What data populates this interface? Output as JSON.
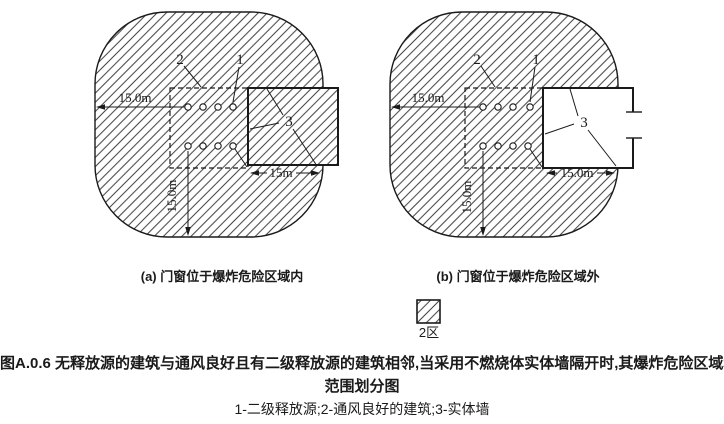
{
  "figure": {
    "id_title_line1": "图A.0.6 无释放源的建筑与通风良好且有二级释放源的建筑相邻,当采用不燃烧体实体墙隔开时,其爆炸危险区域和",
    "id_title_line2": "范围划分图",
    "key_line": "1-二级释放源;2-通风良好的建筑;3-实体墙",
    "legend": {
      "zone_label": "2区"
    },
    "colors": {
      "line": "#1a1a1a",
      "background": "#ffffff"
    },
    "diagram_a": {
      "caption": "(a) 门窗位于爆炸危险区域内",
      "label_1": "1",
      "label_2": "2",
      "label_3": "3",
      "dim_left": "15.0m",
      "dim_bottom": "15m",
      "dim_vertical": "15.0m"
    },
    "diagram_b": {
      "caption": "(b) 门窗位于爆炸危险区域外",
      "label_1": "1",
      "label_2": "2",
      "label_3": "3",
      "dim_left": "15.0m",
      "dim_bottom": "15.0m",
      "dim_vertical": "15.0m"
    }
  }
}
